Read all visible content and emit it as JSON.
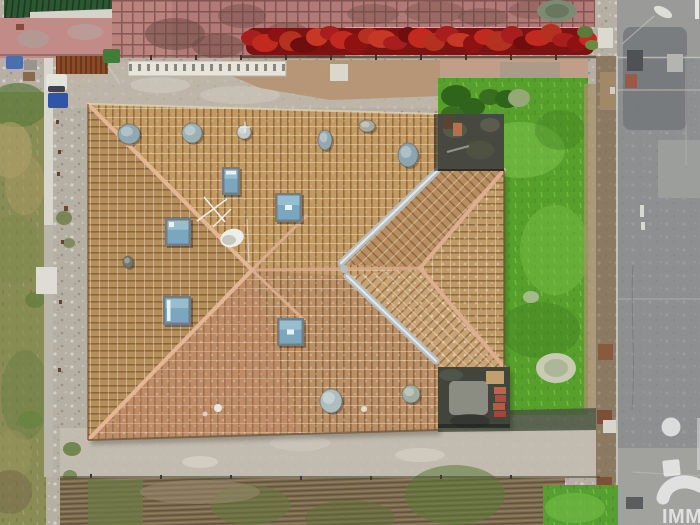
{
  "meta": {
    "type": "aerial-drone-photo",
    "description": "Top-down aerial view of a house with a large tan tiled hip roof, skylights and roof vents, surrounded by gravel, a bright green garden, a red autumn hedge, an olive grass strip and a grey road with a brick boundary wall."
  },
  "watermark": {
    "text": "IMM",
    "color": "#ffffff",
    "opacity": 0.68
  },
  "palette": {
    "roof_tile": "#c39a61",
    "roof_ridge": "#e3b694",
    "valley_zinc": "#b6bec2",
    "skylight_glass": "#7ca6be",
    "skylight_frame": "#6f7e84",
    "gravel": "#b6b0a4",
    "garden_grass": "#58a02c",
    "olive_grass": "#8a8c55",
    "hedge_red": "#a81d1d",
    "road_asphalt": "#8d8f91",
    "brick_wall": "#8b7962",
    "annex_roof": "#474840",
    "terrace_pink": "#b27a76",
    "green_roof": "#2d5733"
  },
  "roof": {
    "skylights": [
      {
        "name": "skylight",
        "x": 222,
        "y": 167,
        "w": 18,
        "h": 28,
        "glint": "bar-top"
      },
      {
        "name": "skylight",
        "x": 275,
        "y": 193,
        "w": 27,
        "h": 29,
        "glint": "center"
      },
      {
        "name": "skylight",
        "x": 165,
        "y": 218,
        "w": 26,
        "h": 28,
        "glint": "dot-tl"
      },
      {
        "name": "skylight",
        "x": 163,
        "y": 296,
        "w": 28,
        "h": 29,
        "glint": "bar-left"
      },
      {
        "name": "skylight",
        "x": 277,
        "y": 318,
        "w": 27,
        "h": 28,
        "glint": "center"
      }
    ],
    "vents": [
      {
        "name": "roof-vent",
        "cx": 129,
        "cy": 134,
        "rx": 11,
        "ry": 10,
        "fill": "#8fa8b2"
      },
      {
        "name": "roof-vent",
        "cx": 192,
        "cy": 133,
        "rx": 10,
        "ry": 10,
        "fill": "#9db0b4"
      },
      {
        "name": "roof-vent",
        "cx": 244,
        "cy": 132,
        "rx": 7,
        "ry": 7,
        "fill": "#c2c9c7"
      },
      {
        "name": "roof-vent",
        "cx": 325,
        "cy": 140,
        "rx": 7,
        "ry": 10,
        "fill": "#93a8b0"
      },
      {
        "name": "roof-vent",
        "cx": 367,
        "cy": 126,
        "rx": 8,
        "ry": 6,
        "fill": "#a9a9a0"
      },
      {
        "name": "roof-vent",
        "cx": 408,
        "cy": 155,
        "rx": 10,
        "ry": 12,
        "fill": "#8ca4ae"
      },
      {
        "name": "roof-vent",
        "cx": 331,
        "cy": 401,
        "rx": 11,
        "ry": 12,
        "fill": "#aebdbd"
      },
      {
        "name": "roof-vent",
        "cx": 411,
        "cy": 394,
        "rx": 9,
        "ry": 9,
        "fill": "#9fae9f"
      },
      {
        "name": "roof-vent",
        "cx": 128,
        "cy": 262,
        "rx": 5,
        "ry": 6,
        "fill": "#73776e"
      }
    ]
  },
  "objects": {
    "yard_items": [
      {
        "name": "blue-tarp",
        "shape": "rect",
        "x": 6,
        "y": 56,
        "w": 17,
        "h": 13,
        "rx": 2,
        "fill": "#4a6fae"
      },
      {
        "name": "grey-crate",
        "shape": "rect",
        "x": 24,
        "y": 60,
        "w": 13,
        "h": 10,
        "fill": "#9a958c"
      },
      {
        "name": "brown-crate",
        "shape": "rect",
        "x": 23,
        "y": 72,
        "w": 12,
        "h": 9,
        "fill": "#8a6a4c"
      },
      {
        "name": "white-van-roof",
        "shape": "rect",
        "x": 46,
        "y": 74,
        "w": 21,
        "h": 17,
        "rx": 3,
        "fill": "#e4e4de"
      },
      {
        "name": "van-windshield",
        "shape": "rect",
        "x": 48,
        "y": 86,
        "w": 17,
        "h": 6,
        "rx": 2,
        "fill": "#3c4450"
      },
      {
        "name": "blue-wheelie-bin",
        "shape": "rect",
        "x": 48,
        "y": 93,
        "w": 20,
        "h": 15,
        "rx": 2,
        "fill": "#2e55a8"
      },
      {
        "name": "green-wheelie-bin",
        "shape": "rect",
        "x": 103,
        "y": 49,
        "w": 17,
        "h": 14,
        "rx": 2,
        "fill": "#3f7d38"
      },
      {
        "name": "white-sign",
        "shape": "rect",
        "x": 330,
        "y": 64,
        "w": 18,
        "h": 17,
        "fill": "#dad7cd"
      },
      {
        "name": "white-shed-roof",
        "shape": "rect",
        "x": 36,
        "y": 267,
        "w": 21,
        "h": 27,
        "fill": "#dedcd4"
      }
    ],
    "wall_blocks": [
      {
        "name": "white-post",
        "shape": "rect",
        "x": 598,
        "y": 28,
        "w": 15,
        "h": 20,
        "fill": "#dcdad0"
      },
      {
        "name": "tan-wall-block",
        "shape": "rect",
        "x": 600,
        "y": 72,
        "w": 16,
        "h": 38,
        "fill": "#a08868"
      },
      {
        "name": "white-tick",
        "shape": "rect",
        "x": 610,
        "y": 87,
        "w": 5,
        "h": 7,
        "fill": "#cfcdc4"
      },
      {
        "name": "brown-wall-block",
        "shape": "rect",
        "x": 598,
        "y": 344,
        "w": 15,
        "h": 16,
        "fill": "#8a5a40"
      },
      {
        "name": "brown-wall-block",
        "shape": "rect",
        "x": 597,
        "y": 410,
        "w": 15,
        "h": 14,
        "fill": "#7d4f38"
      },
      {
        "name": "white-post",
        "shape": "rect",
        "x": 603,
        "y": 420,
        "w": 13,
        "h": 13,
        "fill": "#d8d6cc"
      },
      {
        "name": "brown-wall-block",
        "shape": "rect",
        "x": 597,
        "y": 477,
        "w": 15,
        "h": 12,
        "fill": "#7d5038"
      },
      {
        "name": "white-post",
        "shape": "rect",
        "x": 604,
        "y": 489,
        "w": 12,
        "h": 11,
        "fill": "#d4d2c8"
      }
    ],
    "road_marks": [
      {
        "name": "manhole-cover",
        "shape": "rect",
        "x": 627,
        "y": 50,
        "w": 16,
        "h": 21,
        "fill": "#4f5254"
      },
      {
        "name": "utility-cover",
        "shape": "rect",
        "x": 667,
        "y": 54,
        "w": 16,
        "h": 18,
        "fill": "#b4b5b0"
      },
      {
        "name": "red-marker",
        "shape": "rect",
        "x": 625,
        "y": 74,
        "w": 12,
        "h": 14,
        "fill": "#9a5a44"
      },
      {
        "name": "white-dash",
        "shape": "rect",
        "x": 640,
        "y": 205,
        "w": 4,
        "h": 12,
        "fill": "#d8d8d2"
      },
      {
        "name": "white-dash",
        "shape": "rect",
        "x": 641,
        "y": 222,
        "w": 4,
        "h": 8,
        "fill": "#d8d8d2"
      },
      {
        "name": "manhole-cover",
        "shape": "rect",
        "x": 626,
        "y": 497,
        "w": 17,
        "h": 12,
        "fill": "#5a5d5e"
      },
      {
        "name": "white-edge-line",
        "shape": "rect",
        "x": 695,
        "y": 0,
        "w": 4,
        "h": 19,
        "fill": "#e8e8e2"
      }
    ],
    "annex_items": [
      {
        "name": "dark-planter",
        "shape": "rect",
        "x": 444,
        "y": 117,
        "w": 9,
        "h": 12,
        "fill": "#5f4130"
      },
      {
        "name": "terracotta-pot",
        "shape": "rect",
        "x": 453,
        "y": 123,
        "w": 9,
        "h": 13,
        "fill": "#b5714e"
      },
      {
        "name": "wood-plank-stack",
        "shape": "rect",
        "x": 486,
        "y": 371,
        "w": 18,
        "h": 13,
        "fill": "#c2a06e"
      },
      {
        "name": "red-brick",
        "shape": "rect",
        "x": 494,
        "y": 387,
        "w": 12,
        "h": 7,
        "fill": "#c75f4a"
      },
      {
        "name": "red-brick",
        "shape": "rect",
        "x": 495,
        "y": 395,
        "w": 11,
        "h": 7,
        "fill": "#b14a38"
      },
      {
        "name": "red-brick",
        "shape": "rect",
        "x": 493,
        "y": 403,
        "w": 12,
        "h": 7,
        "fill": "#c0563f"
      },
      {
        "name": "red-brick",
        "shape": "rect",
        "x": 494,
        "y": 411,
        "w": 12,
        "h": 6,
        "fill": "#a84434"
      }
    ],
    "hedge_blobs": [
      {
        "name": "hedge-bush",
        "shape": "ellipse",
        "cx": 252,
        "cy": 38,
        "rx": 11,
        "ry": 8,
        "fill": "#a81d1d"
      },
      {
        "name": "hedge-bush",
        "shape": "ellipse",
        "cx": 265,
        "cy": 43,
        "rx": 13,
        "ry": 9,
        "fill": "#c22a1f"
      },
      {
        "name": "hedge-bush",
        "shape": "ellipse",
        "cx": 278,
        "cy": 35,
        "rx": 10,
        "ry": 7,
        "fill": "#8e1212"
      },
      {
        "name": "hedge-bush",
        "shape": "ellipse",
        "cx": 291,
        "cy": 41,
        "rx": 12,
        "ry": 10,
        "fill": "#b5311f"
      },
      {
        "name": "hedge-bush",
        "shape": "ellipse",
        "cx": 304,
        "cy": 45,
        "rx": 14,
        "ry": 8,
        "fill": "#6f0e0e"
      },
      {
        "name": "hedge-bush",
        "shape": "ellipse",
        "cx": 317,
        "cy": 37,
        "rx": 11,
        "ry": 9,
        "fill": "#c63726"
      },
      {
        "name": "hedge-bush",
        "shape": "ellipse",
        "cx": 330,
        "cy": 33,
        "rx": 10,
        "ry": 7,
        "fill": "#a81d1d"
      },
      {
        "name": "hedge-bush",
        "shape": "ellipse",
        "cx": 343,
        "cy": 40,
        "rx": 13,
        "ry": 9,
        "fill": "#c22a1f"
      },
      {
        "name": "hedge-bush",
        "shape": "ellipse",
        "cx": 356,
        "cy": 44,
        "rx": 12,
        "ry": 10,
        "fill": "#8e1212"
      },
      {
        "name": "hedge-bush",
        "shape": "ellipse",
        "cx": 369,
        "cy": 36,
        "rx": 11,
        "ry": 8,
        "fill": "#b5311f"
      },
      {
        "name": "hedge-bush",
        "shape": "ellipse",
        "cx": 382,
        "cy": 39,
        "rx": 14,
        "ry": 9,
        "fill": "#c63726"
      },
      {
        "name": "hedge-bush",
        "shape": "ellipse",
        "cx": 395,
        "cy": 43,
        "rx": 12,
        "ry": 7,
        "fill": "#a81d1d"
      },
      {
        "name": "hedge-bush",
        "shape": "ellipse",
        "cx": 408,
        "cy": 35,
        "rx": 10,
        "ry": 8,
        "fill": "#6f0e0e"
      },
      {
        "name": "hedge-bush",
        "shape": "ellipse",
        "cx": 421,
        "cy": 38,
        "rx": 13,
        "ry": 10,
        "fill": "#c22a1f"
      },
      {
        "name": "hedge-bush",
        "shape": "ellipse",
        "cx": 434,
        "cy": 42,
        "rx": 11,
        "ry": 9,
        "fill": "#b5311f"
      },
      {
        "name": "hedge-bush",
        "shape": "ellipse",
        "cx": 447,
        "cy": 34,
        "rx": 12,
        "ry": 8,
        "fill": "#a81d1d"
      },
      {
        "name": "hedge-bush",
        "shape": "ellipse",
        "cx": 460,
        "cy": 40,
        "rx": 13,
        "ry": 7,
        "fill": "#c63726"
      },
      {
        "name": "hedge-bush",
        "shape": "ellipse",
        "cx": 473,
        "cy": 44,
        "rx": 10,
        "ry": 9,
        "fill": "#8e1212"
      },
      {
        "name": "hedge-bush",
        "shape": "ellipse",
        "cx": 486,
        "cy": 37,
        "rx": 12,
        "ry": 8,
        "fill": "#c22a1f"
      },
      {
        "name": "hedge-bush",
        "shape": "ellipse",
        "cx": 499,
        "cy": 41,
        "rx": 14,
        "ry": 10,
        "fill": "#b5311f"
      },
      {
        "name": "hedge-bush",
        "shape": "ellipse",
        "cx": 512,
        "cy": 35,
        "rx": 11,
        "ry": 9,
        "fill": "#a81d1d"
      },
      {
        "name": "hedge-bush",
        "shape": "ellipse",
        "cx": 525,
        "cy": 43,
        "rx": 12,
        "ry": 7,
        "fill": "#6f0e0e"
      },
      {
        "name": "hedge-bush",
        "shape": "ellipse",
        "cx": 538,
        "cy": 38,
        "rx": 13,
        "ry": 8,
        "fill": "#c22a1f"
      },
      {
        "name": "hedge-bush",
        "shape": "ellipse",
        "cx": 551,
        "cy": 33,
        "rx": 11,
        "ry": 9,
        "fill": "#b5311f"
      },
      {
        "name": "hedge-bush",
        "shape": "ellipse",
        "cx": 564,
        "cy": 40,
        "rx": 12,
        "ry": 7,
        "fill": "#a81d1d"
      },
      {
        "name": "hedge-bush",
        "shape": "ellipse",
        "cx": 577,
        "cy": 44,
        "rx": 10,
        "ry": 8,
        "fill": "#8e1212"
      },
      {
        "name": "hedge-bush",
        "shape": "ellipse",
        "cx": 588,
        "cy": 39,
        "rx": 9,
        "ry": 7,
        "fill": "#c22a1f"
      },
      {
        "name": "hedge-green-tuft",
        "shape": "ellipse",
        "cx": 585,
        "cy": 32,
        "rx": 8,
        "ry": 6,
        "fill": "#5e7a3a"
      },
      {
        "name": "hedge-green-tuft",
        "shape": "ellipse",
        "cx": 592,
        "cy": 45,
        "rx": 7,
        "ry": 5,
        "fill": "#6d8a42"
      }
    ],
    "fence_posts": [
      {
        "name": "fence-post",
        "shape": "rect",
        "x": 150,
        "y": 55,
        "w": 2,
        "h": 5,
        "fill": "#3a352c"
      },
      {
        "name": "fence-post",
        "shape": "rect",
        "x": 195,
        "y": 55,
        "w": 2,
        "h": 5,
        "fill": "#3a352c"
      },
      {
        "name": "fence-post",
        "shape": "rect",
        "x": 240,
        "y": 55,
        "w": 2,
        "h": 5,
        "fill": "#3a352c"
      },
      {
        "name": "fence-post",
        "shape": "rect",
        "x": 285,
        "y": 55,
        "w": 2,
        "h": 5,
        "fill": "#3a352c"
      },
      {
        "name": "fence-post",
        "shape": "rect",
        "x": 330,
        "y": 55,
        "w": 2,
        "h": 5,
        "fill": "#3a352c"
      },
      {
        "name": "fence-post",
        "shape": "rect",
        "x": 375,
        "y": 55,
        "w": 2,
        "h": 5,
        "fill": "#3a352c"
      },
      {
        "name": "fence-post",
        "shape": "rect",
        "x": 420,
        "y": 55,
        "w": 2,
        "h": 5,
        "fill": "#3a352c"
      },
      {
        "name": "fence-post",
        "shape": "rect",
        "x": 465,
        "y": 55,
        "w": 2,
        "h": 5,
        "fill": "#3a352c"
      },
      {
        "name": "fence-post",
        "shape": "rect",
        "x": 510,
        "y": 55,
        "w": 2,
        "h": 5,
        "fill": "#3a352c"
      },
      {
        "name": "fence-post",
        "shape": "rect",
        "x": 555,
        "y": 55,
        "w": 2,
        "h": 5,
        "fill": "#3a352c"
      },
      {
        "name": "fence-post",
        "shape": "rect",
        "x": 56,
        "y": 120,
        "w": 3,
        "h": 4,
        "fill": "#5f4632"
      },
      {
        "name": "fence-post",
        "shape": "rect",
        "x": 58,
        "y": 150,
        "w": 3,
        "h": 4,
        "fill": "#5f4632"
      },
      {
        "name": "fence-post",
        "shape": "rect",
        "x": 57,
        "y": 172,
        "w": 3,
        "h": 4,
        "fill": "#5f4632"
      },
      {
        "name": "fence-post",
        "shape": "rect",
        "x": 64,
        "y": 206,
        "w": 4,
        "h": 5,
        "fill": "#6a4a30"
      },
      {
        "name": "fence-post",
        "shape": "rect",
        "x": 61,
        "y": 240,
        "w": 3,
        "h": 4,
        "fill": "#5f4632"
      },
      {
        "name": "fence-post",
        "shape": "rect",
        "x": 59,
        "y": 300,
        "w": 3,
        "h": 4,
        "fill": "#5f4632"
      },
      {
        "name": "fence-post",
        "shape": "rect",
        "x": 58,
        "y": 368,
        "w": 3,
        "h": 4,
        "fill": "#5f4632"
      },
      {
        "name": "fence-post",
        "shape": "rect",
        "x": 90,
        "y": 474,
        "w": 2,
        "h": 4,
        "fill": "#3f3a30"
      },
      {
        "name": "fence-post",
        "shape": "rect",
        "x": 160,
        "y": 475,
        "w": 2,
        "h": 4,
        "fill": "#3f3a30"
      },
      {
        "name": "fence-post",
        "shape": "rect",
        "x": 230,
        "y": 475,
        "w": 2,
        "h": 4,
        "fill": "#3f3a30"
      },
      {
        "name": "fence-post",
        "shape": "rect",
        "x": 300,
        "y": 476,
        "w": 2,
        "h": 4,
        "fill": "#3f3a30"
      },
      {
        "name": "fence-post",
        "shape": "rect",
        "x": 370,
        "y": 476,
        "w": 2,
        "h": 4,
        "fill": "#3f3a30"
      },
      {
        "name": "fence-post",
        "shape": "rect",
        "x": 440,
        "y": 475,
        "w": 2,
        "h": 4,
        "fill": "#3f3a30"
      },
      {
        "name": "fence-post",
        "shape": "rect",
        "x": 510,
        "y": 475,
        "w": 2,
        "h": 4,
        "fill": "#3f3a30"
      }
    ]
  }
}
